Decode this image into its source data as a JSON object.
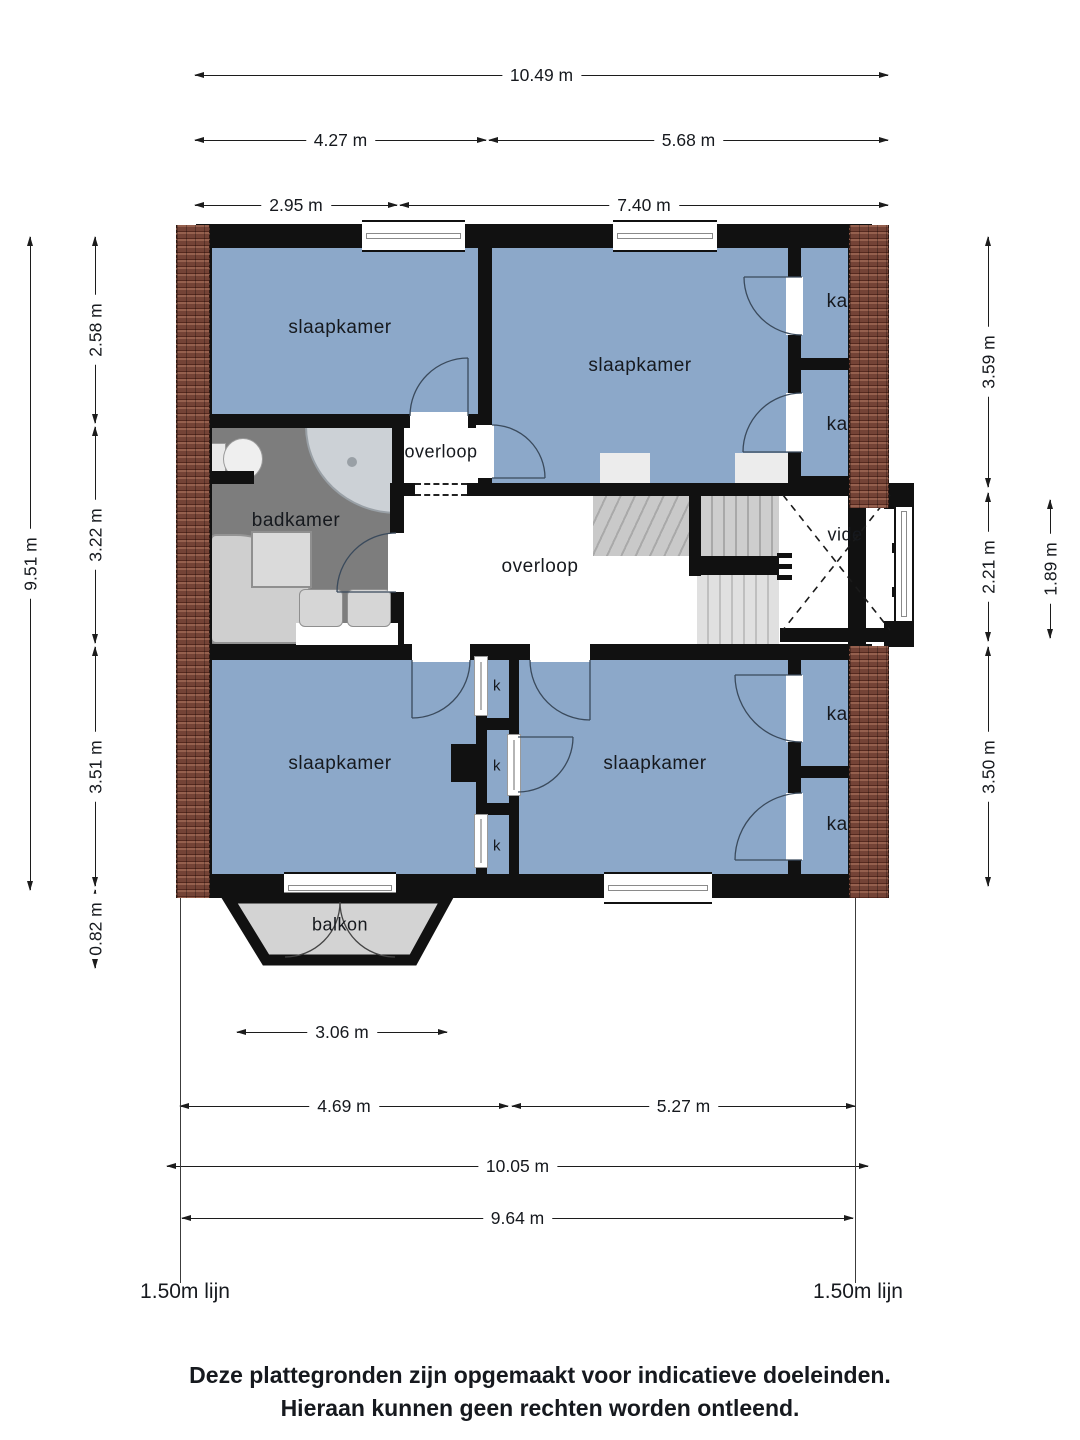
{
  "rooms": {
    "bedroom": "slaapkamer",
    "bathroom": "badkamer",
    "landing": "overloop",
    "void": "vide",
    "closet": "kast",
    "closet_small": "k",
    "balcony": "balkon"
  },
  "dims_top": {
    "total": "10.49 m",
    "left": "4.27 m",
    "right": "5.68 m",
    "left2": "2.95 m",
    "right2": "7.40 m"
  },
  "dims_left": {
    "total": "9.51 m",
    "top": "2.58 m",
    "middle": "3.22 m",
    "bottom": "3.51 m",
    "balcony": "0.82 m"
  },
  "dims_right": {
    "top": "3.59 m",
    "middle": "2.21 m",
    "void": "1.89 m",
    "bottom": "3.50 m"
  },
  "dims_bottom": {
    "balcony": "3.06 m",
    "left": "4.69 m",
    "right": "5.27 m",
    "total": "10.05 m",
    "inner": "9.64 m"
  },
  "lines": {
    "left": "1.50m lijn",
    "right": "1.50m lijn"
  },
  "footer": {
    "line1": "Deze plattegronden zijn opgemaakt voor indicatieve doeleinden.",
    "line2": "Hieraan kunnen geen rechten worden ontleend."
  },
  "colors": {
    "room_blue": "#8ca8c9",
    "bathroom_gray": "#7d7d7d",
    "balcony_gray": "#d3d3d3",
    "wall_black": "#111111",
    "brick_red": "#744336"
  }
}
